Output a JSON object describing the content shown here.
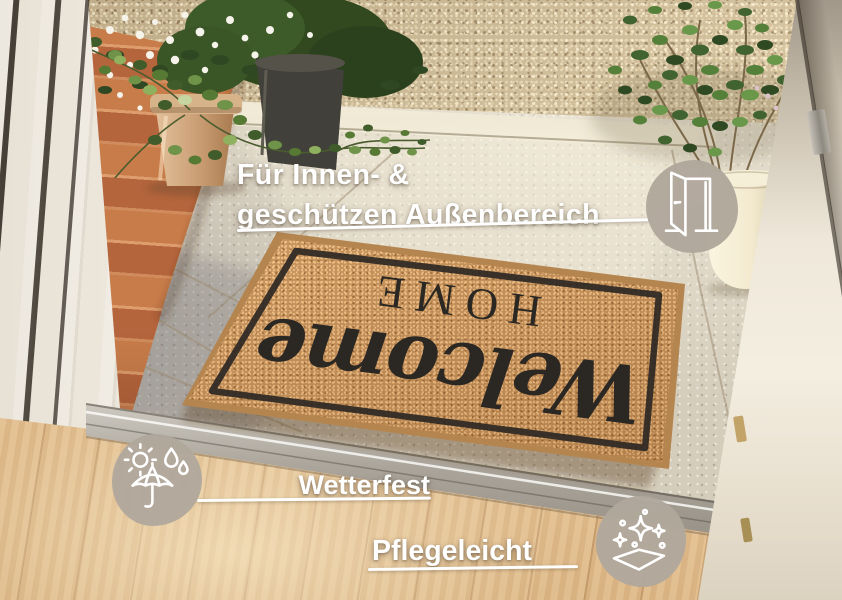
{
  "headline": {
    "line1": "Für Innen- &",
    "line2": "geschützen Außenbereich"
  },
  "features": {
    "area": {
      "icon": "open-door-icon"
    },
    "weatherproof": {
      "label": "Wetterfest",
      "icon": "sun-umbrella-raindrops-icon"
    },
    "easycare": {
      "label": "Pflegeleicht",
      "icon": "sparkles-clean-icon"
    }
  },
  "doormat": {
    "script_word": "Welcome",
    "caps_word": "HOME"
  },
  "palette": {
    "overlay_text": "#ffffff",
    "icon_badge": "#b1a79c",
    "coir": "#c08c57",
    "mat_print": "#2b2723"
  }
}
